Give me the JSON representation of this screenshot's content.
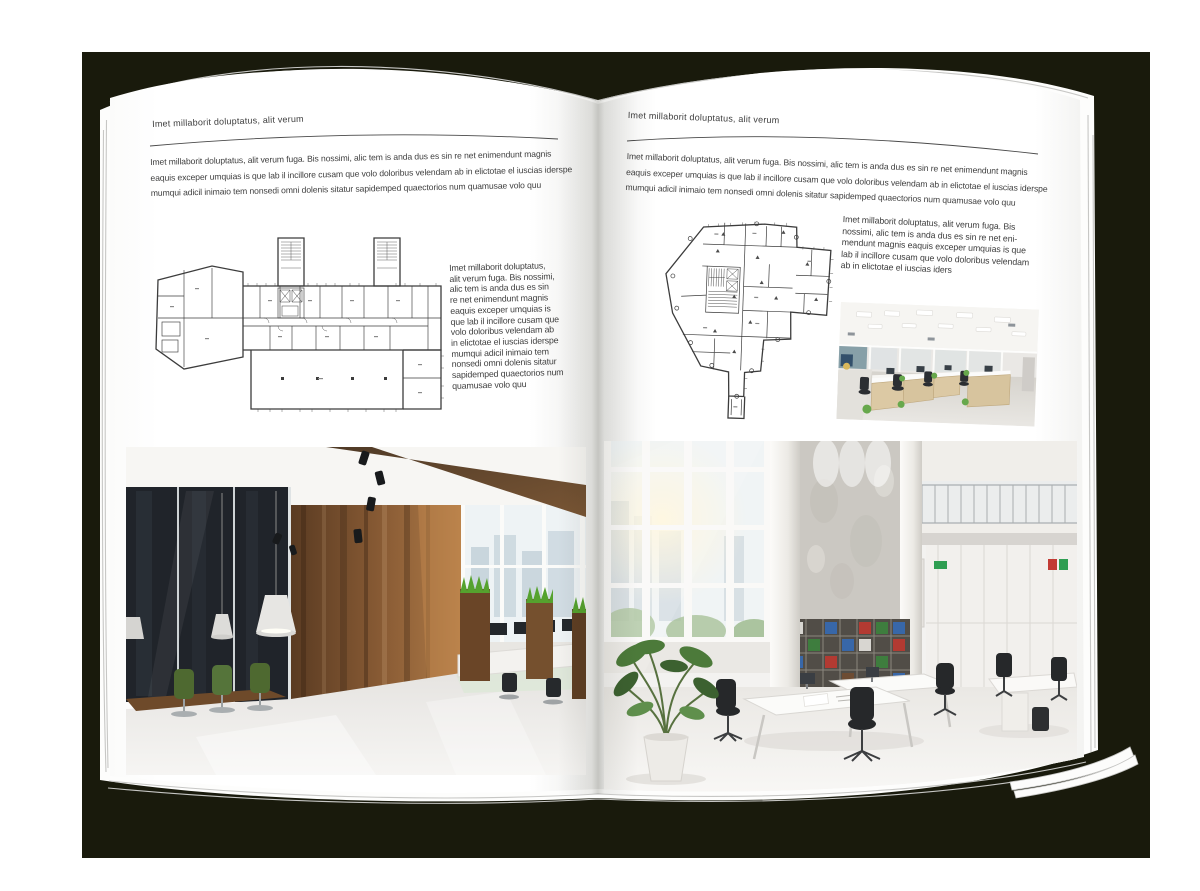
{
  "document_type": "open magazine spread mockup",
  "colors": {
    "backdrop": "#191a0c",
    "paper": "#ffffff",
    "text": "#3d3d3d",
    "rule": "#4a4a4a",
    "plan_line": "#3c3c3c",
    "wood_dark": "#6b4526",
    "wood_light": "#dcc9a4",
    "grass_green": "#54a02c",
    "chair_green": "#4e6930",
    "binder_green": "#3e7d3e",
    "binder_blue": "#3867a8",
    "binder_red": "#b23a32"
  },
  "left_page": {
    "header": "Imet millaborit doluptatus, alit verum",
    "intro_lines": [
      "Imet millaborit doluptatus, alit verum fuga. Bis nossimi, alic tem is anda dus es sin re net enimendunt magnis",
      "eaquis exceper umquias is que lab il incillore cusam que volo doloribus velendam ab in elictotae el iuscias iderspe",
      "mumqui adicil inimaio tem nonsedi omni dolenis sitatur sapidemped quaectorios num quamusae volo quu"
    ],
    "caption_lines": [
      "Imet millaborit doluptatus,",
      "alit verum fuga. Bis nossimi,",
      "alic tem is anda dus es sin",
      "re net enimendunt magnis",
      "eaquis exceper umquias is",
      "que lab il incillore cusam que",
      "volo doloribus velendam ab",
      "in elictotae el iuscias iderspe",
      "mumqui adicil inimaio tem",
      "nonsedi omni dolenis sitatur",
      "sapidemped quaectorios num",
      "quamusae volo quu"
    ]
  },
  "right_page": {
    "header": "Imet millaborit doluptatus, alit verum",
    "intro_lines": [
      "Imet millaborit doluptatus, alit verum fuga. Bis nossimi, alic tem is anda dus es sin re net enimendunt magnis",
      "eaquis exceper umquias is que lab il incillore cusam que volo doloribus velendam ab in elictotae el iuscias iderspe",
      "mumqui adicil inimaio tem nonsedi omni dolenis sitatur sapidemped quaectorios num quamusae volo quu"
    ],
    "caption_lines": [
      "Imet millaborit doluptatus, alit verum fuga. Bis",
      "nossimi, alic tem is anda dus es sin re net eni-",
      "mendunt magnis eaquis exceper umquias is que",
      "lab il incillore cusam que volo doloribus velendam",
      "ab in elictotae el iuscias iders"
    ]
  }
}
